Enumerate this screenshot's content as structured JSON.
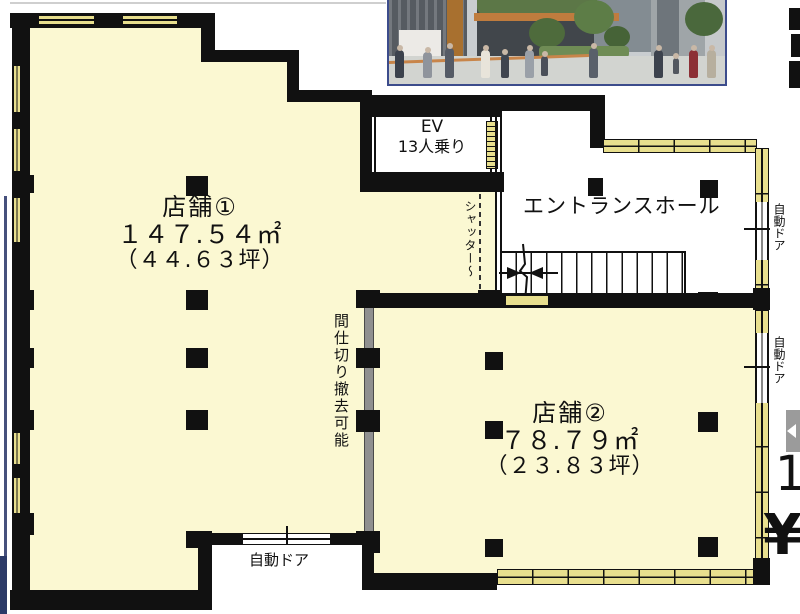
{
  "plan": {
    "elevator": {
      "name": "EV",
      "capacity": "13人乗り"
    },
    "entrance_hall_label": "エントランスホール",
    "shutter_label": "シャッター〜",
    "partition_label": "間仕切り撤去可能",
    "store1": {
      "name": "店舗①",
      "area_m2": "１４７.５４㎡",
      "area_tsubo": "（４４.６３坪）"
    },
    "store2": {
      "name": "店舗②",
      "area_m2": "７８.７９㎡",
      "area_tsubo": "（２３.８３坪）"
    },
    "auto_door_right_upper": "自動ドア",
    "auto_door_right_lower": "自動ドア",
    "auto_door_bottom": "自動ドア"
  },
  "edge_fragments": {
    "number": "1",
    "yen": "¥"
  },
  "colors": {
    "floor": "#fbf8d2",
    "window": "#e8df8e",
    "wall": "#111111",
    "partition_gray": "#909090",
    "photo_border": "#3c4c8c",
    "arrow_gray": "#9b9b9b"
  }
}
